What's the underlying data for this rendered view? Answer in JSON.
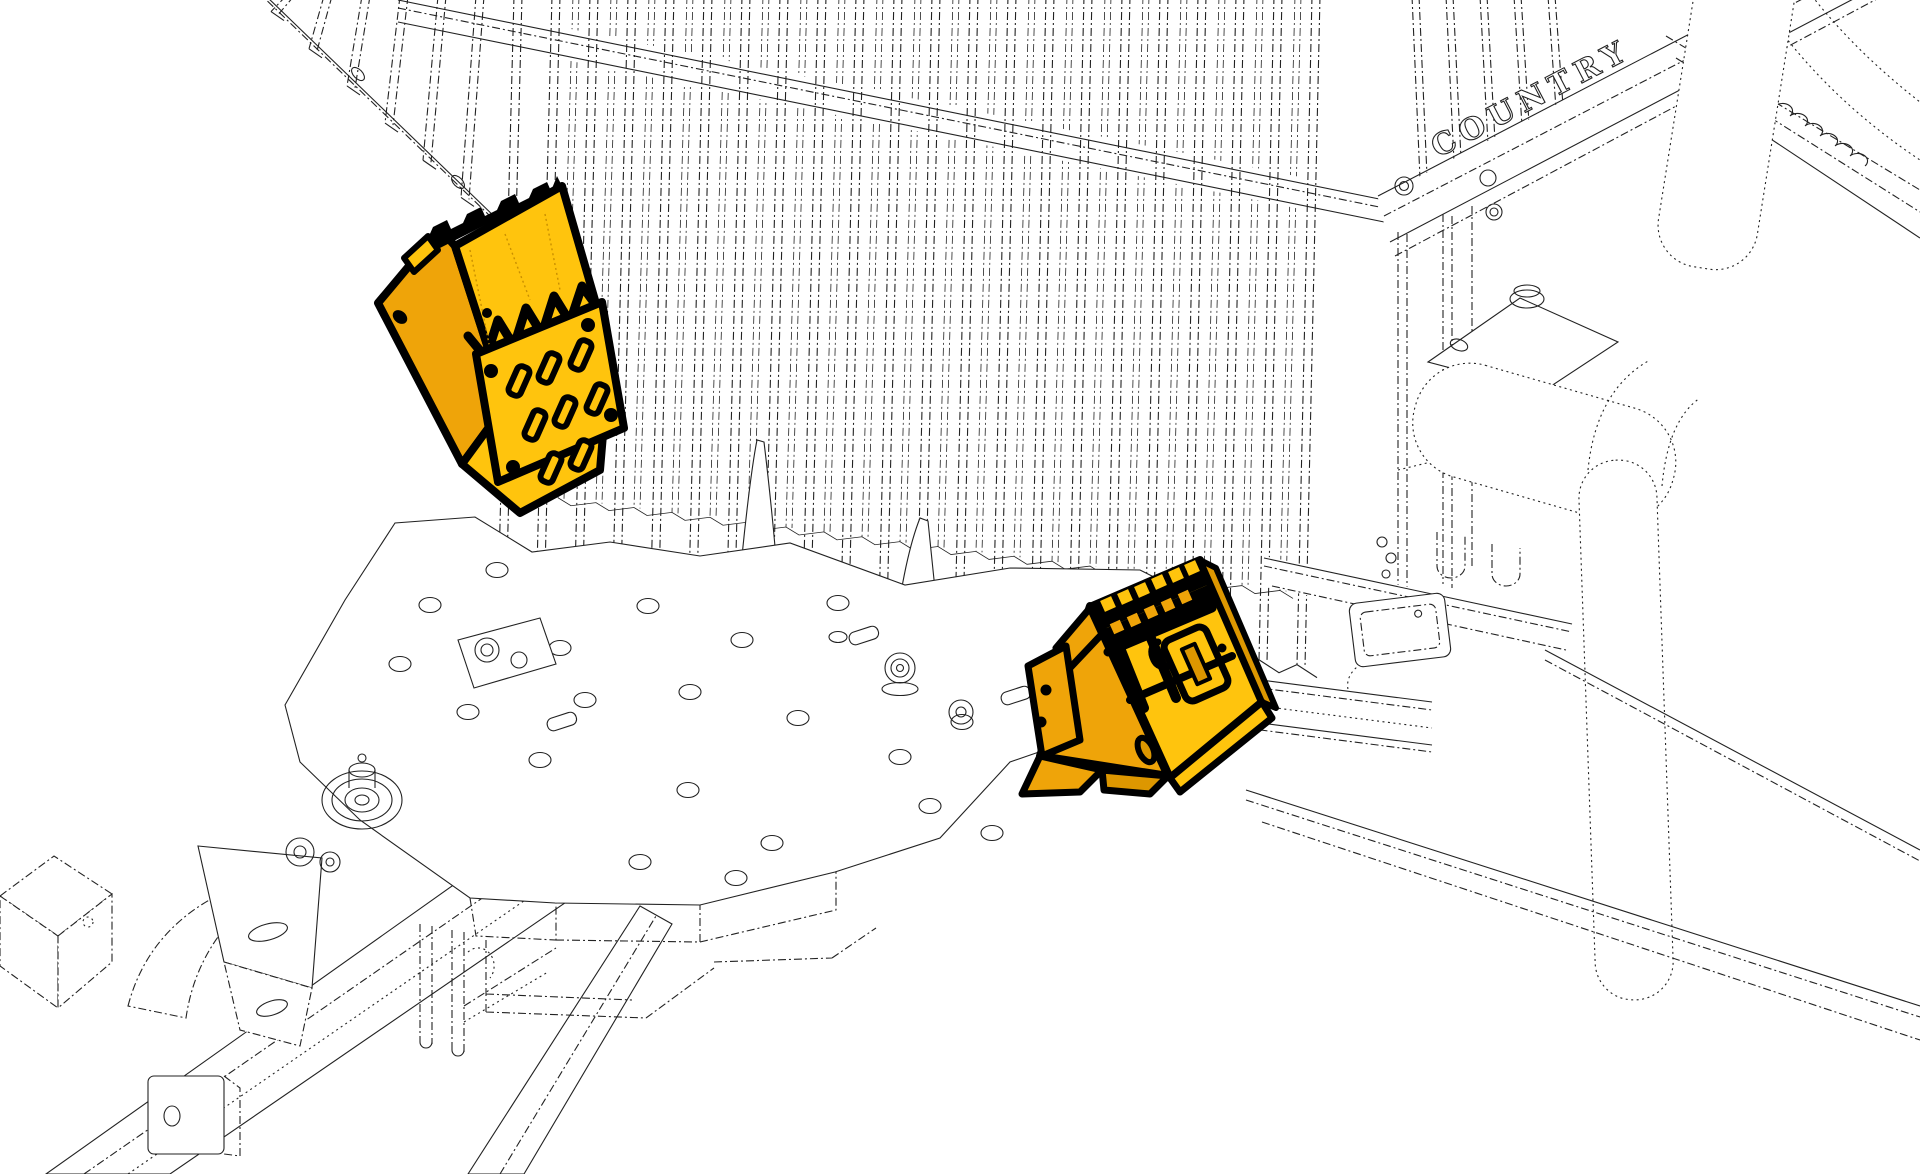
{
  "page": {
    "background": "#FFFFFF"
  },
  "illustration": {
    "brand_text": "COUNTRY",
    "line_color": "#222222",
    "highlight_colors": {
      "bright_yellow": "#FFC40D",
      "gold": "#EFA409",
      "dark_gold": "#DD9700",
      "outline": "#000000"
    },
    "highlighted_parts": [
      {
        "id": "left-chock-bracket"
      },
      {
        "id": "right-chock-bracket"
      }
    ]
  }
}
